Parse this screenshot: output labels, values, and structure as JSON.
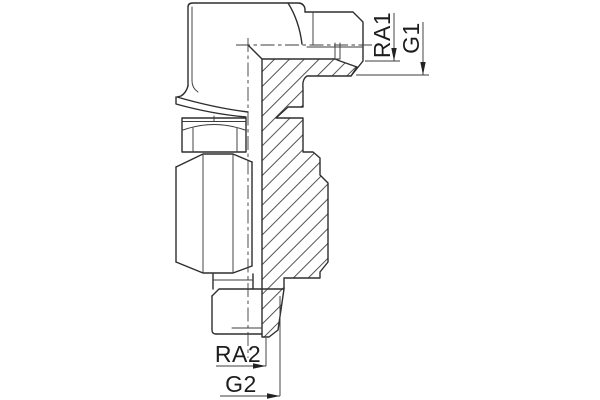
{
  "drawing": {
    "type": "technical-drawing",
    "subject": "90-degree elbow fitting, half-section view with hatching",
    "labels": {
      "ra1": "RA1",
      "g1": "G1",
      "ra2": "RA2",
      "g2": "G2"
    },
    "colors": {
      "outline": "#2e2e2e",
      "thin_line": "#3c3c3c",
      "hatch": "#3f3f3f",
      "centerline": "#3c3c3c",
      "label": "#1c1c1c",
      "background": "#ffffff"
    }
  }
}
